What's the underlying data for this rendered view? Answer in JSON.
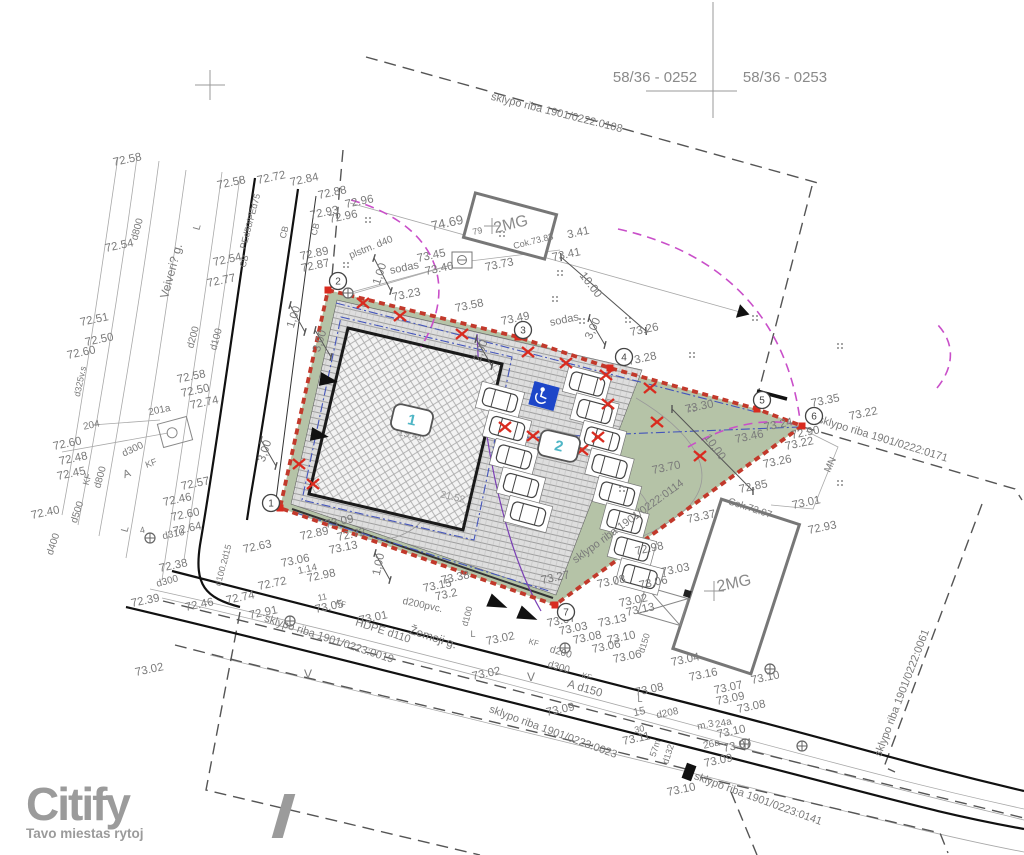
{
  "header": {
    "plot_left": "58/36 - 0252",
    "plot_right": "58/36 - 0253"
  },
  "logo": {
    "name": "Citify",
    "tagline": "Tavo miestas rytoj"
  },
  "colors": {
    "boundary_red": "#c2392b",
    "x_red": "#d92b1f",
    "site_green": "#b5c3a7",
    "magenta": "#c94fc9",
    "blue_dash": "#4455bb",
    "violet": "#7a3fb5",
    "badge_text": "#4fb6c6",
    "handicap": "#1d46c8",
    "text_gray": "#7a7a7a",
    "logo_gray": "#9b9b9b"
  },
  "badges": [
    {
      "n": "1",
      "x": 412,
      "y": 420
    },
    {
      "n": "2",
      "x": 559,
      "y": 446
    }
  ],
  "markers": [
    {
      "n": "1",
      "x": 271,
      "y": 503
    },
    {
      "n": "2",
      "x": 338,
      "y": 281
    },
    {
      "n": "3",
      "x": 523,
      "y": 330
    },
    {
      "n": "4",
      "x": 624,
      "y": 357
    },
    {
      "n": "5",
      "x": 762,
      "y": 400
    },
    {
      "n": "6",
      "x": 814,
      "y": 416
    },
    {
      "n": "7",
      "x": 566,
      "y": 612
    }
  ],
  "labels": [
    {
      "t": "72.58",
      "x": 128,
      "y": 163
    },
    {
      "t": "72.58",
      "x": 232,
      "y": 186
    },
    {
      "t": "72.72",
      "x": 272,
      "y": 181
    },
    {
      "t": "72.84",
      "x": 305,
      "y": 183
    },
    {
      "t": "72.88",
      "x": 333,
      "y": 196
    },
    {
      "t": "72.96",
      "x": 360,
      "y": 205
    },
    {
      "t": "72.93",
      "x": 325,
      "y": 216
    },
    {
      "t": "72.96",
      "x": 344,
      "y": 220
    },
    {
      "t": "72.89",
      "x": 315,
      "y": 257
    },
    {
      "t": "72.87",
      "x": 316,
      "y": 269
    },
    {
      "t": "72.54",
      "x": 120,
      "y": 249
    },
    {
      "t": "72.54",
      "x": 228,
      "y": 263
    },
    {
      "t": "72.77",
      "x": 222,
      "y": 284
    },
    {
      "t": "72.51",
      "x": 95,
      "y": 323
    },
    {
      "t": "72.50",
      "x": 100,
      "y": 343
    },
    {
      "t": "72.60",
      "x": 82,
      "y": 356
    },
    {
      "t": "72.58",
      "x": 192,
      "y": 380
    },
    {
      "t": "72.50",
      "x": 196,
      "y": 394
    },
    {
      "t": "72.74",
      "x": 205,
      "y": 406
    },
    {
      "t": "201a",
      "x": 160,
      "y": 413,
      "s": 10
    },
    {
      "t": "204",
      "x": 92,
      "y": 428,
      "s": 10
    },
    {
      "t": "72.60",
      "x": 68,
      "y": 447
    },
    {
      "t": "72.48",
      "x": 74,
      "y": 462
    },
    {
      "t": "72.45",
      "x": 72,
      "y": 477
    },
    {
      "t": "72.57",
      "x": 196,
      "y": 487
    },
    {
      "t": "72.46",
      "x": 178,
      "y": 503
    },
    {
      "t": "72.60",
      "x": 186,
      "y": 518
    },
    {
      "t": "72.64",
      "x": 188,
      "y": 532
    },
    {
      "t": "72.40",
      "x": 46,
      "y": 516
    },
    {
      "t": "4",
      "x": 143,
      "y": 533,
      "s": 9
    },
    {
      "t": "d310",
      "x": 174,
      "y": 537,
      "s": 10
    },
    {
      "t": "72.63",
      "x": 258,
      "y": 550
    },
    {
      "t": "72.38",
      "x": 174,
      "y": 569
    },
    {
      "t": "72.39",
      "x": 146,
      "y": 604
    },
    {
      "t": "72.46",
      "x": 200,
      "y": 608
    },
    {
      "t": "72.74",
      "x": 241,
      "y": 601
    },
    {
      "t": "72.91",
      "x": 264,
      "y": 616
    },
    {
      "t": "72.72",
      "x": 273,
      "y": 587
    },
    {
      "t": "73.02",
      "x": 150,
      "y": 673
    },
    {
      "t": "Veiveri? g.",
      "x": 175,
      "y": 272,
      "r": -75,
      "s": 12
    },
    {
      "t": "d800",
      "x": 140,
      "y": 230,
      "r": -75,
      "s": 10
    },
    {
      "t": "d800",
      "x": 103,
      "y": 478,
      "r": -75,
      "s": 10
    },
    {
      "t": "d500",
      "x": 80,
      "y": 513,
      "r": -72,
      "s": 10
    },
    {
      "t": "d400",
      "x": 56,
      "y": 545,
      "r": -72,
      "s": 10
    },
    {
      "t": "d325v.s",
      "x": 83,
      "y": 382,
      "r": -78,
      "s": 9
    },
    {
      "t": "d300",
      "x": 134,
      "y": 452,
      "r": -25,
      "s": 10
    },
    {
      "t": "d200",
      "x": 196,
      "y": 338,
      "r": -75,
      "s": 10
    },
    {
      "t": "d100",
      "x": 219,
      "y": 340,
      "r": -75,
      "s": 10
    },
    {
      "t": "d300",
      "x": 168,
      "y": 584,
      "r": -15,
      "s": 10
    },
    {
      "t": "d100.2d15",
      "x": 226,
      "y": 566,
      "r": -75,
      "s": 9
    },
    {
      "t": "PEd50/PEd75",
      "x": 253,
      "y": 222,
      "r": -75,
      "s": 9
    },
    {
      "t": "CB",
      "x": 287,
      "y": 233,
      "r": -75,
      "s": 9
    },
    {
      "t": "CB",
      "x": 318,
      "y": 230,
      "r": -75,
      "s": 9
    },
    {
      "t": "CB",
      "x": 247,
      "y": 262,
      "r": -75,
      "s": 9
    },
    {
      "t": "KF",
      "x": 152,
      "y": 466,
      "r": -20,
      "s": 9
    },
    {
      "t": "KF",
      "x": 90,
      "y": 480,
      "r": -75,
      "s": 9
    },
    {
      "t": "L",
      "x": 200,
      "y": 228,
      "r": -75,
      "s": 10
    },
    {
      "t": "L",
      "x": 128,
      "y": 530,
      "r": -75,
      "s": 10
    },
    {
      "t": "A",
      "x": 128,
      "y": 477,
      "r": -20,
      "s": 11
    },
    {
      "t": "1.14",
      "x": 308,
      "y": 572,
      "s": 10
    },
    {
      "t": "11",
      "x": 323,
      "y": 600,
      "s": 9
    },
    {
      "t": "73.05",
      "x": 330,
      "y": 610
    },
    {
      "t": "73.01",
      "x": 374,
      "y": 621
    },
    {
      "t": "73.13",
      "x": 344,
      "y": 551
    },
    {
      "t": "73.06",
      "x": 296,
      "y": 564
    },
    {
      "t": "72.98",
      "x": 322,
      "y": 579
    },
    {
      "t": "72.89",
      "x": 315,
      "y": 537
    },
    {
      "t": "72.72",
      "x": 352,
      "y": 538
    },
    {
      "t": "73.09",
      "x": 340,
      "y": 525
    },
    {
      "t": "1,00",
      "x": 382,
      "y": 565,
      "r": -78
    },
    {
      "t": "73.38",
      "x": 456,
      "y": 581
    },
    {
      "t": "73.15",
      "x": 438,
      "y": 589
    },
    {
      "t": "73.2",
      "x": 447,
      "y": 598
    },
    {
      "t": "73.27",
      "x": 556,
      "y": 581
    },
    {
      "t": "73.08",
      "x": 612,
      "y": 585
    },
    {
      "t": "73.06",
      "x": 654,
      "y": 586
    },
    {
      "t": "73.03",
      "x": 676,
      "y": 573
    },
    {
      "t": "73.02",
      "x": 634,
      "y": 604
    },
    {
      "t": "73.13",
      "x": 641,
      "y": 613
    },
    {
      "t": "73.13",
      "x": 613,
      "y": 624
    },
    {
      "t": "73.07",
      "x": 562,
      "y": 624
    },
    {
      "t": "73.03",
      "x": 574,
      "y": 632
    },
    {
      "t": "73.08",
      "x": 588,
      "y": 641
    },
    {
      "t": "73.10",
      "x": 622,
      "y": 641
    },
    {
      "t": "73.06",
      "x": 607,
      "y": 650
    },
    {
      "t": "73.06",
      "x": 628,
      "y": 660
    },
    {
      "t": "73.04",
      "x": 686,
      "y": 663
    },
    {
      "t": "73.16",
      "x": 704,
      "y": 678
    },
    {
      "t": "73.08",
      "x": 650,
      "y": 693
    },
    {
      "t": "73.02",
      "x": 501,
      "y": 642
    },
    {
      "t": "73.02",
      "x": 487,
      "y": 677
    },
    {
      "t": "V",
      "x": 531,
      "y": 681,
      "r": 0,
      "s": 12
    },
    {
      "t": "V",
      "x": 308,
      "y": 678,
      "r": 0,
      "s": 12
    },
    {
      "t": "A  d150",
      "x": 584,
      "y": 692,
      "r": 16
    },
    {
      "t": "d200",
      "x": 560,
      "y": 655,
      "r": 16,
      "s": 10
    },
    {
      "t": "d300",
      "x": 558,
      "y": 670,
      "r": 16,
      "s": 10
    },
    {
      "t": "KF",
      "x": 533,
      "y": 645,
      "r": 16,
      "s": 8
    },
    {
      "t": "KF",
      "x": 586,
      "y": 679,
      "r": 16,
      "s": 8
    },
    {
      "t": "KF",
      "x": 340,
      "y": 606,
      "r": 16,
      "s": 8
    },
    {
      "t": "L",
      "x": 473,
      "y": 637,
      "r": 0,
      "s": 9
    },
    {
      "t": "L",
      "x": 640,
      "y": 702,
      "r": 0,
      "s": 9
    },
    {
      "t": "d100",
      "x": 470,
      "y": 617,
      "r": -75,
      "s": 9
    },
    {
      "t": "d150",
      "x": 647,
      "y": 644,
      "r": -72,
      "s": 9
    },
    {
      "t": "73.09",
      "x": 561,
      "y": 713
    },
    {
      "t": "15",
      "x": 640,
      "y": 715,
      "s": 11
    },
    {
      "t": "d208",
      "x": 668,
      "y": 716,
      "s": 10
    },
    {
      "t": "m.3",
      "x": 706,
      "y": 728,
      "s": 10
    },
    {
      "t": "30",
      "x": 640,
      "y": 732,
      "s": 9
    },
    {
      "t": "73.11",
      "x": 637,
      "y": 742
    },
    {
      "t": "57m",
      "x": 658,
      "y": 749,
      "r": -72,
      "s": 9
    },
    {
      "t": "d132",
      "x": 671,
      "y": 755,
      "r": -72,
      "s": 9
    },
    {
      "t": "24a",
      "x": 724,
      "y": 726,
      "s": 10
    },
    {
      "t": "26a",
      "x": 712,
      "y": 747,
      "s": 10
    },
    {
      "t": "73.10",
      "x": 732,
      "y": 735
    },
    {
      "t": "73.07",
      "x": 738,
      "y": 749
    },
    {
      "t": "73.09",
      "x": 719,
      "y": 764
    },
    {
      "t": "73.10",
      "x": 682,
      "y": 793
    },
    {
      "t": "73.10",
      "x": 766,
      "y": 681
    },
    {
      "t": "73.07",
      "x": 729,
      "y": 691
    },
    {
      "t": "73.09",
      "x": 731,
      "y": 702
    },
    {
      "t": "73.08",
      "x": 752,
      "y": 710
    },
    {
      "t": "sklypo riba 1901/0223:0019",
      "x": 328,
      "y": 642,
      "r": 18,
      "s": 11
    },
    {
      "t": "sklypo riba 1901/0223:0023",
      "x": 552,
      "y": 735,
      "r": 20,
      "s": 11
    },
    {
      "t": "sklypo riba 1901/0223:0141",
      "x": 757,
      "y": 802,
      "r": 20,
      "s": 11
    },
    {
      "t": "sklypo riba 1901/0222:0061",
      "x": 905,
      "y": 694,
      "r": -69,
      "s": 11
    },
    {
      "t": "sklypo riba 1901/0222:0171",
      "x": 882,
      "y": 442,
      "r": 17,
      "s": 11
    },
    {
      "t": "sklypo riba 1901/0222:0114",
      "x": 630,
      "y": 524,
      "r": -36,
      "s": 11
    },
    {
      "t": "sklypo riba 1901/0222:0108",
      "x": 556,
      "y": 116,
      "r": 14,
      "s": 11
    },
    {
      "t": "Žemoji g.",
      "x": 432,
      "y": 641,
      "r": 18,
      "s": 12
    },
    {
      "t": "HDPE d110",
      "x": 382,
      "y": 634,
      "r": 18,
      "s": 11
    },
    {
      "t": "d200pvc.",
      "x": 422,
      "y": 608,
      "r": 12,
      "s": 10
    },
    {
      "t": "74.69",
      "x": 448,
      "y": 227,
      "s": 13
    },
    {
      "t": "79",
      "x": 478,
      "y": 234,
      "s": 9
    },
    {
      "t": "3.41",
      "x": 579,
      "y": 236
    },
    {
      "t": "73.41",
      "x": 567,
      "y": 258
    },
    {
      "t": "73.45",
      "x": 432,
      "y": 259
    },
    {
      "t": "plstm. d40",
      "x": 372,
      "y": 250,
      "r": -22,
      "s": 10
    },
    {
      "t": "sodas",
      "x": 405,
      "y": 271,
      "s": 11
    },
    {
      "t": "sodas",
      "x": 565,
      "y": 323,
      "s": 11
    },
    {
      "t": "73.40",
      "x": 440,
      "y": 272
    },
    {
      "t": "73.73",
      "x": 500,
      "y": 268
    },
    {
      "t": "73.23",
      "x": 407,
      "y": 298
    },
    {
      "t": "73.58",
      "x": 470,
      "y": 309
    },
    {
      "t": "73.49",
      "x": 516,
      "y": 322
    },
    {
      "t": "73.26",
      "x": 645,
      "y": 333
    },
    {
      "t": "73.28",
      "x": 643,
      "y": 362
    },
    {
      "t": "10.00",
      "x": 588,
      "y": 287,
      "r": 52
    },
    {
      "t": "10,00",
      "x": 712,
      "y": 449,
      "r": 55
    },
    {
      "t": "1,00",
      "x": 383,
      "y": 275,
      "r": -72
    },
    {
      "t": "3,00",
      "x": 323,
      "y": 342,
      "r": -72
    },
    {
      "t": "1,00",
      "x": 297,
      "y": 318,
      "r": -72
    },
    {
      "t": "3,00",
      "x": 268,
      "y": 452,
      "r": -72
    },
    {
      "t": "2,00",
      "x": 484,
      "y": 352,
      "r": -70
    },
    {
      "t": "3,00",
      "x": 596,
      "y": 330,
      "r": -65
    },
    {
      "t": "73.30",
      "x": 700,
      "y": 410
    },
    {
      "t": "73.35",
      "x": 826,
      "y": 404
    },
    {
      "t": "73.22",
      "x": 864,
      "y": 417
    },
    {
      "t": "73.24",
      "x": 779,
      "y": 428
    },
    {
      "t": "72.90",
      "x": 806,
      "y": 436
    },
    {
      "t": "73.46",
      "x": 750,
      "y": 440
    },
    {
      "t": "73.22",
      "x": 800,
      "y": 447
    },
    {
      "t": "73.26",
      "x": 778,
      "y": 465
    },
    {
      "t": "73.70",
      "x": 667,
      "y": 471
    },
    {
      "t": "MN",
      "x": 833,
      "y": 466,
      "r": -65,
      "s": 10
    },
    {
      "t": "72.85",
      "x": 754,
      "y": 490
    },
    {
      "t": "73.01",
      "x": 807,
      "y": 506
    },
    {
      "t": "Cok.72.97",
      "x": 749,
      "y": 511,
      "r": 18,
      "s": 10
    },
    {
      "t": "72.93",
      "x": 823,
      "y": 531
    },
    {
      "t": "73.37",
      "x": 702,
      "y": 520
    },
    {
      "t": "72.98",
      "x": 650,
      "y": 552
    },
    {
      "t": "2MG",
      "x": 512,
      "y": 229,
      "r": -14,
      "s": 16,
      "c": "#8a8a8a"
    },
    {
      "t": "Cok.73.83",
      "x": 534,
      "y": 244,
      "r": -14,
      "s": 9
    },
    {
      "t": "2MG",
      "x": 735,
      "y": 588,
      "r": -12,
      "s": 16,
      "c": "#8a8a8a"
    },
    {
      "t": "15.41",
      "x": 410,
      "y": 438,
      "r": 13,
      "s": 10,
      "c": "#999999"
    },
    {
      "t": "21.52",
      "x": 452,
      "y": 500,
      "r": 13,
      "s": 10,
      "c": "#999999"
    }
  ]
}
